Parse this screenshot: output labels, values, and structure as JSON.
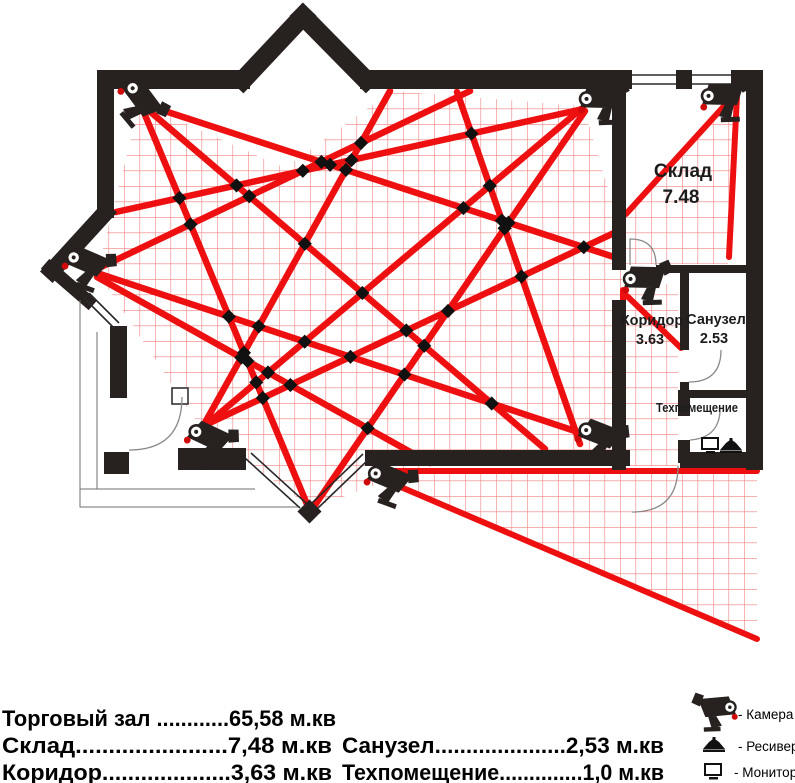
{
  "plan": {
    "rooms": [
      {
        "name": "Склад",
        "area": "7.48"
      },
      {
        "name": "Коридор",
        "area": "3.63"
      },
      {
        "name": "Санузел",
        "area": "2.53"
      },
      {
        "name": "Техпомещение",
        "area": ""
      }
    ]
  },
  "area_table": {
    "left": [
      "Торговый зал ............65,58  м.кв",
      "Склад.......................7,48  м.кв",
      "Коридор....................3,63  м.кв"
    ],
    "right": [
      "Санузел.....................2,53  м.кв",
      "Техпомещение..............1,0  м.кв"
    ]
  },
  "device_legend": [
    {
      "icon": "camera-icon",
      "label": "- Камера"
    },
    {
      "icon": "receiver-icon",
      "label": "- Ресивер"
    },
    {
      "icon": "monitor-icon",
      "label": "- Монитор"
    }
  ],
  "colors": {
    "wall": "#272120",
    "beam": "#ee1010",
    "grid_line": "#f28080",
    "intersection_dot": "#111111"
  }
}
